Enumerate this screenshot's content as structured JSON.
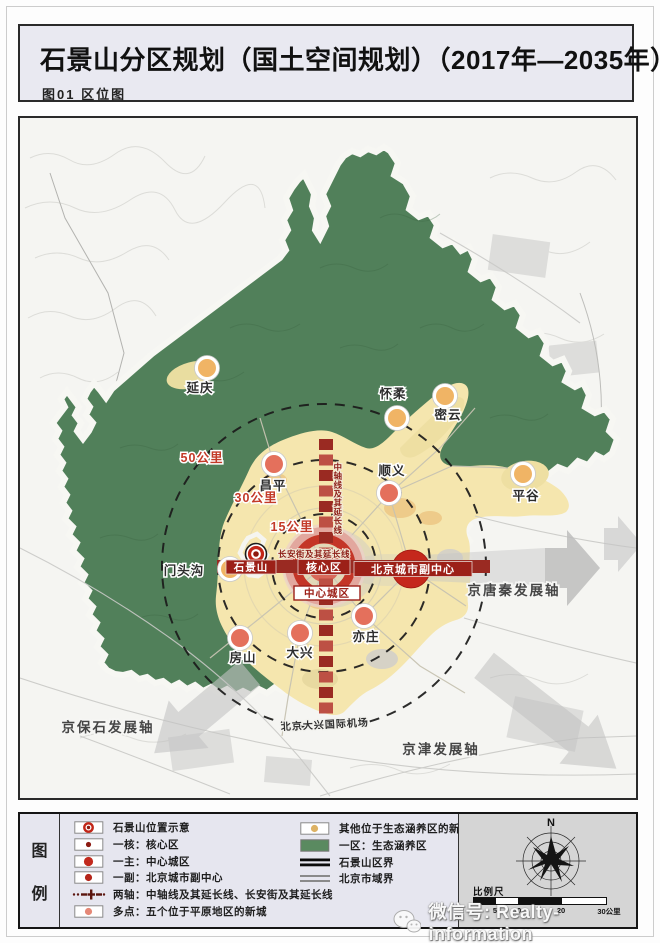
{
  "page": {
    "title": "石景山分区规划（国土空间规划）（2017年—2035年）",
    "subtitle": "图01 区位图"
  },
  "map": {
    "colors": {
      "eco": "#f0b465",
      "plain": "#e4705c",
      "green": "#51805a",
      "plain_bg": "#f5e6ae",
      "axis_red": "#9a2a22",
      "axis_red_alt": "#bd5044",
      "dark_red_box": "#9c2018",
      "core_red": "#c43527"
    },
    "cities": [
      {
        "id": "yanqing",
        "name": "延庆",
        "type": "eco",
        "cx": 187,
        "cy": 250,
        "lx": 180,
        "ly": 274
      },
      {
        "id": "huairou",
        "name": "怀柔",
        "type": "eco",
        "cx": 377,
        "cy": 300,
        "lx": 373,
        "ly": 280
      },
      {
        "id": "miyun",
        "name": "密云",
        "type": "eco",
        "cx": 425,
        "cy": 278,
        "lx": 428,
        "ly": 301
      },
      {
        "id": "pinggu",
        "name": "平谷",
        "type": "eco",
        "cx": 503,
        "cy": 356,
        "lx": 506,
        "ly": 382
      },
      {
        "id": "mentougou",
        "name": "门头沟",
        "type": "eco",
        "cx": 210,
        "cy": 451,
        "lx": 164,
        "ly": 457
      },
      {
        "id": "changping",
        "name": "昌平",
        "type": "plain",
        "cx": 254,
        "cy": 346,
        "lx": 253,
        "ly": 372
      },
      {
        "id": "shunyi",
        "name": "顺义",
        "type": "plain",
        "cx": 369,
        "cy": 375,
        "lx": 372,
        "ly": 357
      },
      {
        "id": "fangshan",
        "name": "房山",
        "type": "plain",
        "cx": 220,
        "cy": 520,
        "lx": 223,
        "ly": 544
      },
      {
        "id": "daxing",
        "name": "大兴",
        "type": "plain",
        "cx": 280,
        "cy": 515,
        "lx": 280,
        "ly": 539
      },
      {
        "id": "yizhuang",
        "name": "亦庄",
        "type": "plain",
        "cx": 344,
        "cy": 498,
        "lx": 346,
        "ly": 523
      }
    ],
    "labels": [
      {
        "id": "ring-15",
        "text": "15公里",
        "x": 272,
        "y": 413,
        "cls": "lbl-ring"
      },
      {
        "id": "ring-30",
        "text": "30公里",
        "x": 236,
        "y": 384,
        "cls": "lbl-ring"
      },
      {
        "id": "ring-50",
        "text": "50公里",
        "x": 182,
        "y": 344,
        "cls": "lbl-ring"
      },
      {
        "id": "axis-jingbaoshi",
        "text": "京保石发展轴",
        "x": 88,
        "y": 614,
        "cls": "lbl-axis"
      },
      {
        "id": "axis-jingjin",
        "text": "京津发展轴",
        "x": 421,
        "y": 636,
        "cls": "lbl-axis"
      },
      {
        "id": "axis-jingtangqin",
        "text": "京唐秦发展轴",
        "x": 494,
        "y": 477,
        "cls": "lbl-axis"
      },
      {
        "id": "airport",
        "text": "北京大兴国际机场",
        "x": 305,
        "y": 610,
        "cls": "lbl-airport",
        "rotate": -3
      },
      {
        "id": "changan-axis",
        "text": "长安街及其延长线",
        "x": 294,
        "y": 439,
        "cls": "lbl-redsmall"
      },
      {
        "id": "zhongzhou-axis",
        "text": "中轴线及其延长线",
        "x": 318,
        "y": 352,
        "cls": "lbl-redsmall",
        "vertical": true,
        "step": 9
      }
    ],
    "boxes": [
      {
        "id": "shijingshan-box",
        "label": "石景山",
        "x": 231,
        "y": 449,
        "w": 50,
        "h": 14,
        "style": "dark",
        "fs": 10.5
      },
      {
        "id": "core-area-box",
        "label": "核心区",
        "x": 304,
        "y": 449,
        "w": 52,
        "h": 15,
        "style": "dark",
        "fs": 11
      },
      {
        "id": "central-city-box",
        "label": "中心城区",
        "x": 307,
        "y": 475,
        "w": 66,
        "h": 14,
        "style": "light",
        "fs": 10.5
      },
      {
        "id": "subcenter-box",
        "label": "北京城市副中心",
        "x": 393,
        "y": 451,
        "w": 118,
        "h": 15,
        "style": "dark",
        "fs": 11
      }
    ]
  },
  "legend": {
    "panel_label_top": "图",
    "panel_label_bottom": "例",
    "left": [
      {
        "label": "石景山位置示意"
      },
      {
        "label": "一核：核心区"
      },
      {
        "label": "一主：中心城区"
      },
      {
        "label": "一副：北京城市副中心"
      },
      {
        "label": "两轴：中轴线及其延长线、长安街及其延长线"
      },
      {
        "label": "多点：五个位于平原地区的新城"
      }
    ],
    "right": [
      {
        "label": "其他位于生态涵养区的新城"
      },
      {
        "label": "一区：生态涵养区"
      },
      {
        "label": "石景山区界"
      },
      {
        "label": "北京市域界"
      }
    ],
    "compass_n": "N",
    "scale_label": "比例尺",
    "scale_ticks": [
      "0",
      "5",
      "10",
      "20",
      "30公里"
    ]
  },
  "watermark": {
    "text": "微信号: Realty-information"
  }
}
